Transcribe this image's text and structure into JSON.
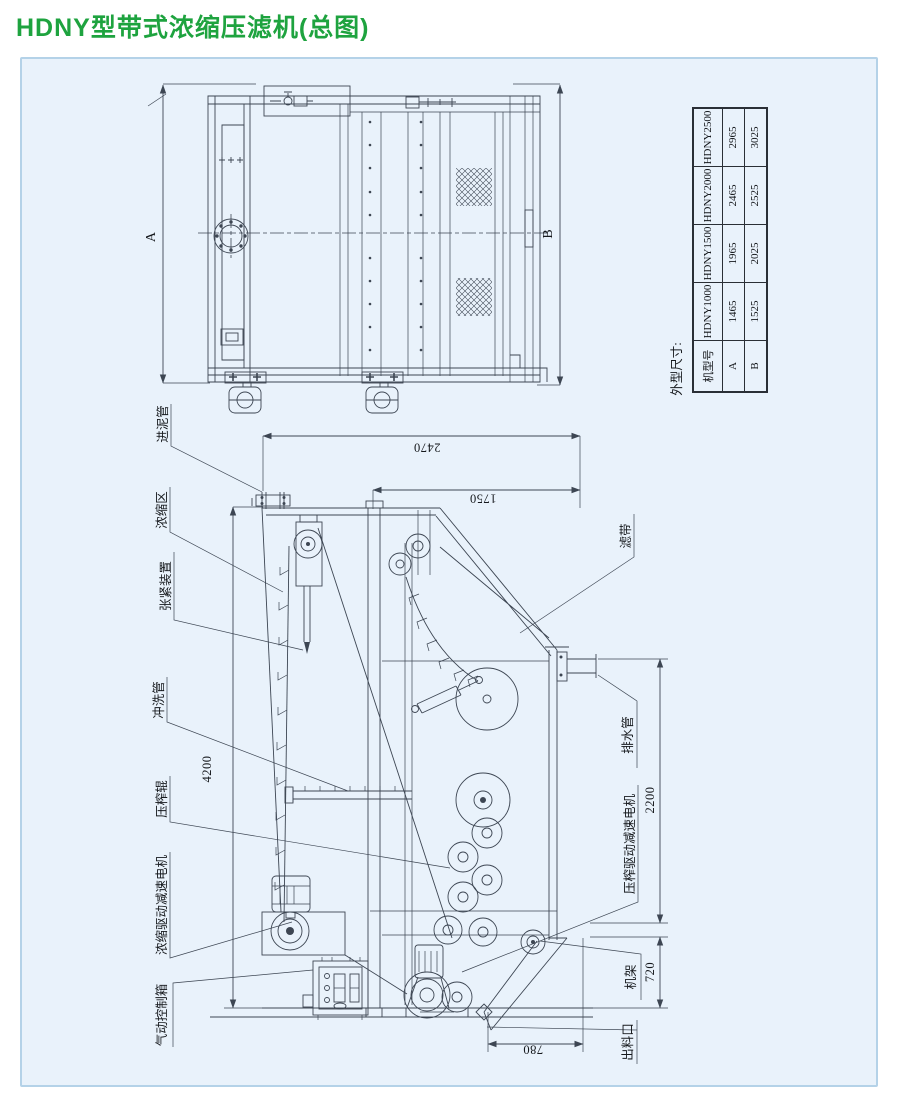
{
  "title": "HDNY型带式浓缩压滤机(总图)",
  "colors": {
    "title_green": "#1ea33f",
    "panel_background": "#e9f2fb",
    "panel_border": "#b4d2e8",
    "line_color": "#3d4653"
  },
  "drawing": {
    "top_view": {
      "dim_left": "A",
      "dim_right": "B"
    },
    "side_view": {
      "parts_left": {
        "inlet_pipe": "进泥管",
        "thickening_zone": "浓缩区",
        "tensioning_device": "张紧装置",
        "flush_pipe": "冲洗管",
        "press_roller": "压榨辊",
        "thickening_drive_motor": "浓缩驱动减速电机",
        "pneumatic_control_box": "气动控制箱"
      },
      "parts_right": {
        "filter_belt": "滤带",
        "drain_pipe": "排水管",
        "press_drive_motor": "压榨驱动减速电机",
        "frame": "机架",
        "outlet": "出料口"
      },
      "dimensions": {
        "total_length": "2470",
        "press_section_length": "1750",
        "total_height": "4200",
        "press_section_height": "2200",
        "base_height": "720",
        "outlet_width": "780"
      }
    }
  },
  "spec_table": {
    "caption": "外型尺寸:",
    "headers": [
      "机型号",
      "HDNY1000",
      "HDNY1500",
      "HDNY2000",
      "HDNY2500"
    ],
    "rows": [
      [
        "A",
        "1465",
        "1965",
        "2465",
        "2965"
      ],
      [
        "B",
        "1525",
        "2025",
        "2525",
        "3025"
      ]
    ]
  }
}
